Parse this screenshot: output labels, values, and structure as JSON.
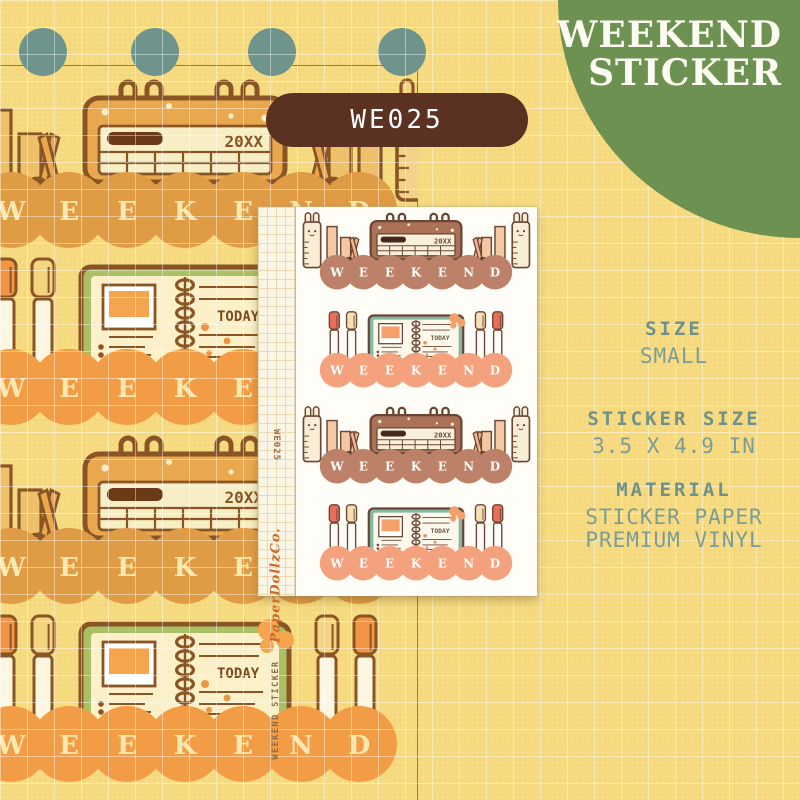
{
  "header": {
    "title_line1": "WEEKEND",
    "title_line2": "STICKER",
    "product_code": "WE025"
  },
  "sheet": {
    "margin_code": "WE025",
    "brand": "PaperDollzCo.",
    "margin_label": "WEEKEND STICKER",
    "stickers_on_sheet": [
      "calendar",
      "notebook",
      "calendar",
      "notebook"
    ]
  },
  "artwork": {
    "word": "WEEKEND",
    "calendar_year": "20XX",
    "notebook_label": "TODAY"
  },
  "specs": [
    {
      "label": "SIZE",
      "values": [
        "SMALL"
      ]
    },
    {
      "label": "STICKER SIZE",
      "values": [
        "3.5 X 4.9 IN"
      ]
    },
    {
      "label": "MATERIAL",
      "values": [
        "STICKER PAPER",
        "PREMIUM VINYL"
      ]
    }
  ],
  "colors": {
    "background": "#f6d97c",
    "grid_line": "rgba(255,255,255,0.42)",
    "banner_green": "#6d9150",
    "hole_teal": "#6f948b",
    "badge_brown": "#5b3222",
    "spec_text": "#7d9c95",
    "frame_line": "#7a5a30",
    "palettes": {
      "left_calendar": {
        "line": "#8a5524",
        "scallop": "#e09c44",
        "letter": "#f9e9b0",
        "body": "#eaa84e",
        "panel": "#f8eec5",
        "dark": "#6b3a17",
        "bunny": "#f3d188",
        "pencil": "#efc06a",
        "scissor": "#eaa84e",
        "pages": "#f8eec5"
      },
      "left_notebook": {
        "line": "#8a5524",
        "scallop": "#f29c45",
        "letter": "#f9e9b0",
        "cover": "#aabf66",
        "pages": "#fbf0c8",
        "photo": "#f5a54e",
        "capA": "#f29545",
        "capB": "#f5d480",
        "penBody": "#fdf6e0",
        "today": "#7a4a1e",
        "accent": "#ef9440"
      },
      "sheet_calendar": {
        "line": "#6b4632",
        "scallop": "#bd8169",
        "letter": "#ffffff",
        "body": "#ab7258",
        "panel": "#f8f0da",
        "dark": "#46291c",
        "bunny": "#f9edd6",
        "pencil": "#f2c9a2",
        "scissor": "#f2b694",
        "pages": "#f8f0da"
      },
      "sheet_notebook": {
        "line": "#6b4632",
        "scallop": "#f4a17e",
        "letter": "#ffffff",
        "cover": "#83b8a4",
        "pages": "#fdf8ec",
        "photo": "#f5a069",
        "capA": "#e76f5c",
        "capB": "#f4e0b2",
        "penBody": "#fefcf6",
        "today": "#6b5340",
        "accent": "#f0906a"
      }
    }
  }
}
